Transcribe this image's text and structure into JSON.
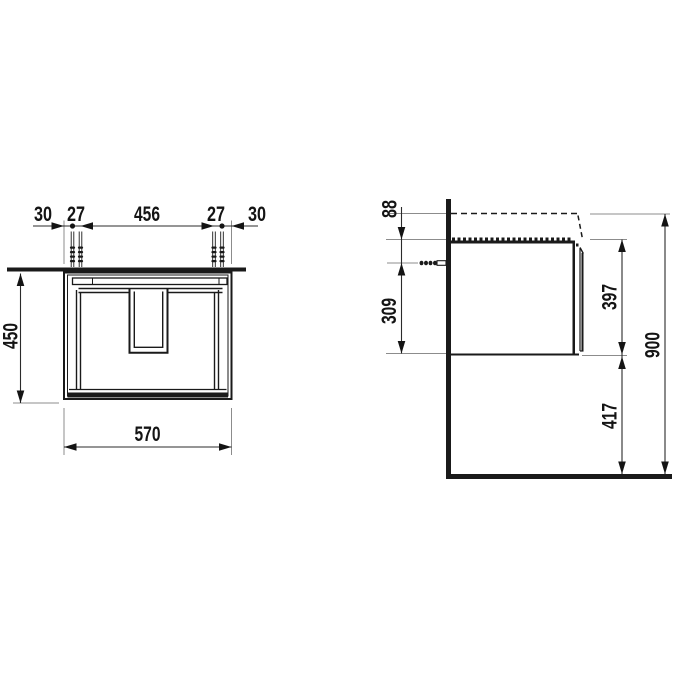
{
  "drawing": {
    "title": "Wall-hung vanity unit installation drawing",
    "units": "mm",
    "views": {
      "front": {
        "top_dims": {
          "edge_left": "30",
          "screw_pair_left": "27",
          "screw_span": "456",
          "screw_pair_right": "27",
          "edge_right": "30"
        },
        "cabinet_height": "450",
        "cabinet_width": "570"
      },
      "side": {
        "basin_top_to_cabinet": "88",
        "screw_to_cabinet_bottom": "309",
        "cabinet_depth_height": "397",
        "floor_clearance": "417",
        "total_install_height": "900"
      }
    }
  }
}
